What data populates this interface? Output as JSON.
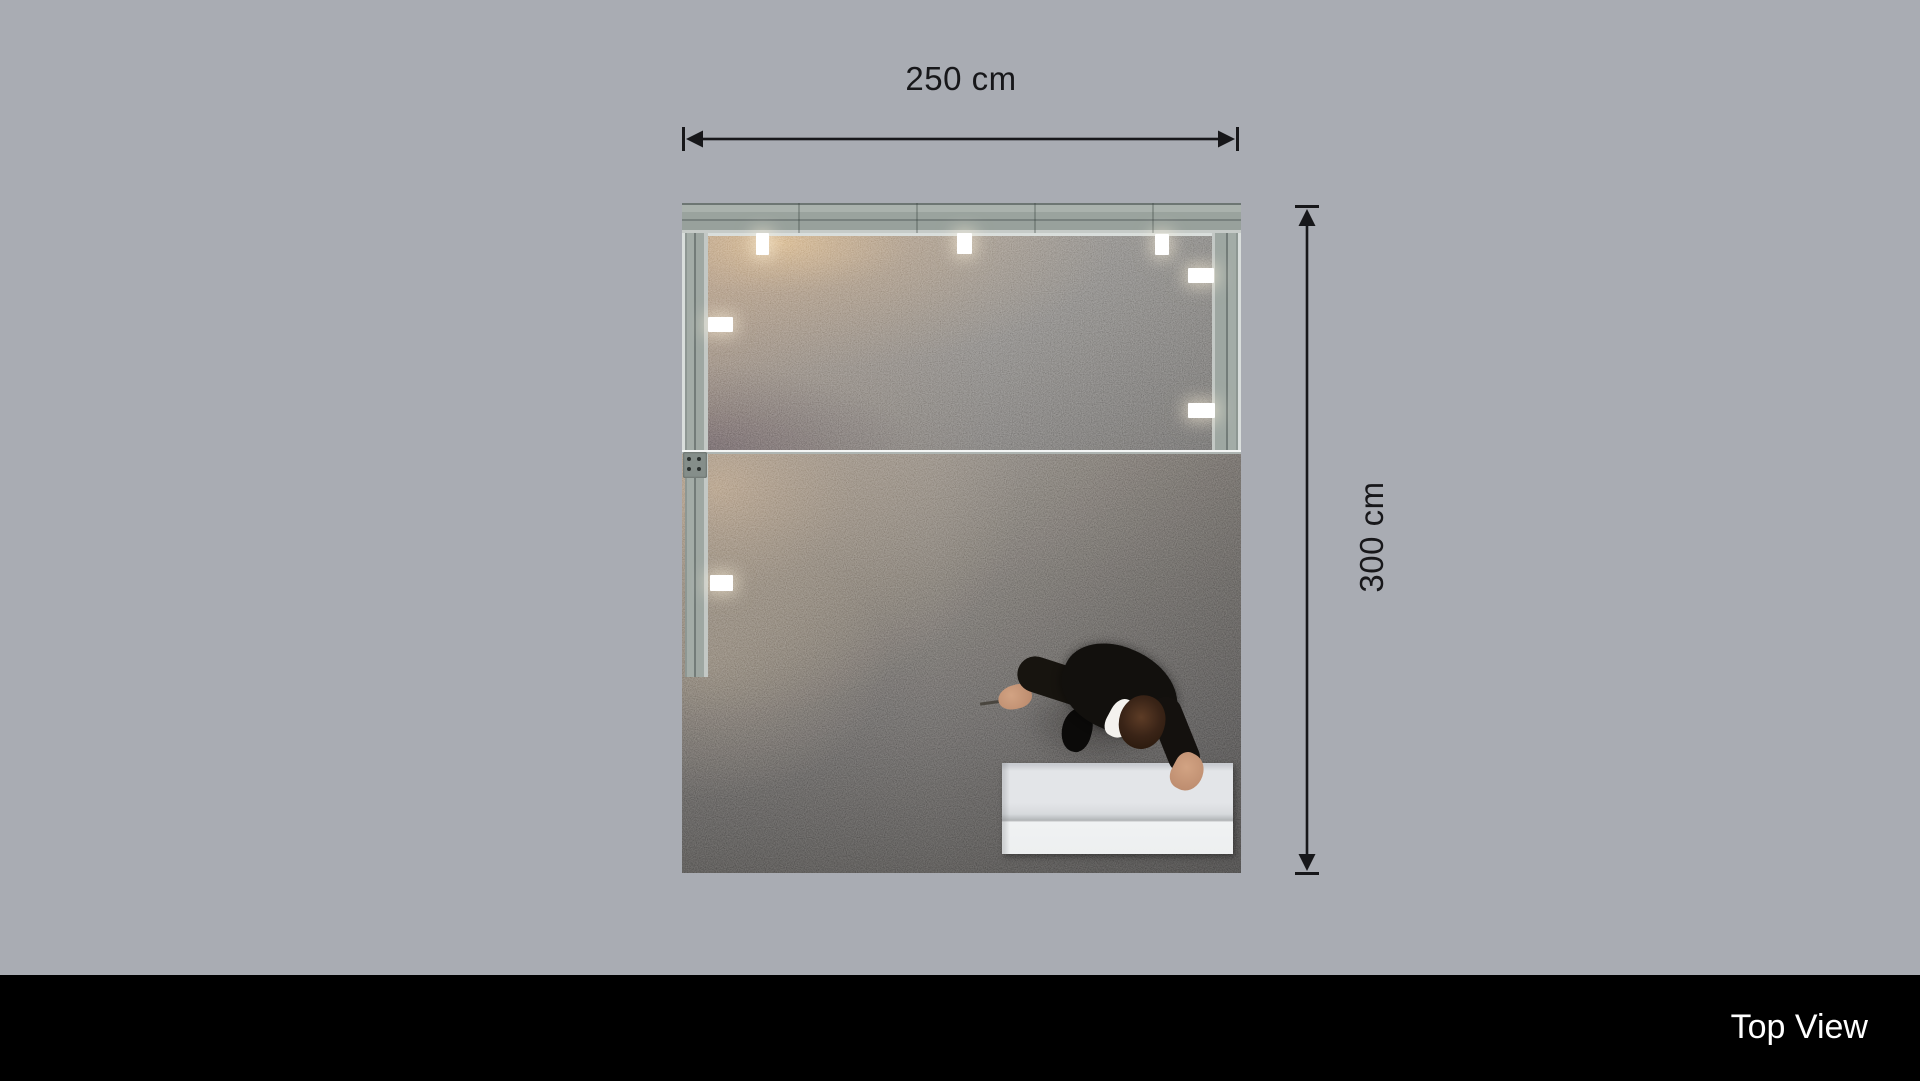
{
  "dimensions": {
    "width_label": "250 cm",
    "height_label": "300 cm",
    "line_color": "#17171a"
  },
  "footer": {
    "view_label": "Top View",
    "background": "#000000",
    "text_color": "#ffffff"
  },
  "scene": {
    "background_color": "#a9acb3",
    "booth": {
      "wall_color": "#9ea7a2",
      "frame_color": "#d9dedc",
      "carpet_upper_color": "#8e8a85",
      "carpet_lower_color": "#565350",
      "counter_color": "#edeff0",
      "light_color": "#ffffff",
      "suit_color": "#12100d",
      "skin_color": "#c59878"
    }
  }
}
